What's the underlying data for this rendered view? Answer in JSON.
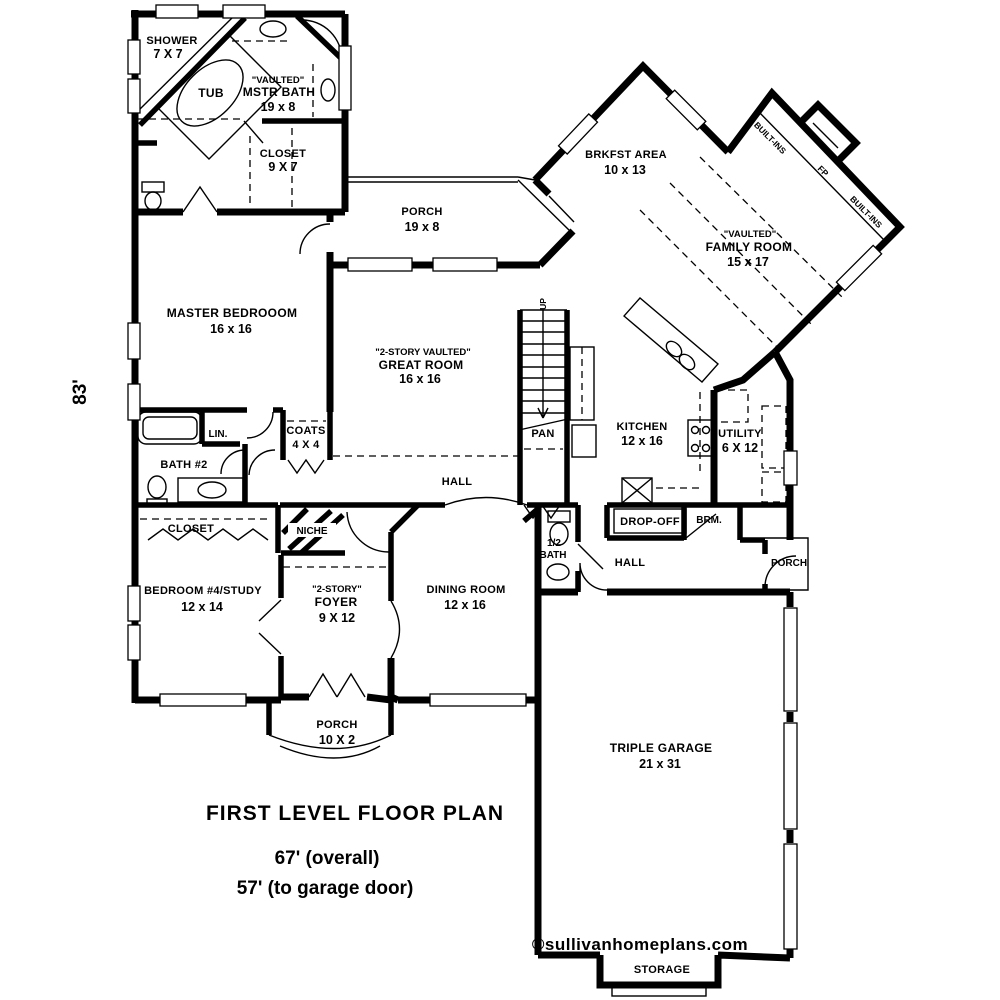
{
  "title_block": {
    "title": "FIRST LEVEL FLOOR PLAN",
    "overall": "67' (overall)",
    "to_garage": "57' (to garage door)"
  },
  "dimensions": {
    "height": "83'"
  },
  "watermark": "©sullivanhomeplans.com",
  "rooms": {
    "shower": {
      "name": "SHOWER",
      "dims": "7 X 7"
    },
    "tub": {
      "name": "TUB"
    },
    "mstr_bath": {
      "tag": "\"VAULTED\"",
      "name": "MSTR BATH",
      "dims": "19 x 8"
    },
    "mstr_closet": {
      "name": "CLOSET",
      "dims": "9 X 7"
    },
    "porch_top": {
      "name": "PORCH",
      "dims": "19 x 8"
    },
    "brkfst": {
      "name": "BRKFST AREA",
      "dims": "10 x 13"
    },
    "family": {
      "tag": "\"VAULTED\"",
      "name": "FAMILY ROOM",
      "dims": "15 x 17"
    },
    "builtins_a": {
      "name": "BUILT-INS"
    },
    "fp": {
      "name": "FP"
    },
    "builtins_b": {
      "name": "BUILT-INS"
    },
    "master": {
      "name": "MASTER BEDROOOM",
      "dims": "16 x 16"
    },
    "great": {
      "tag": "\"2-STORY VAULTED\"",
      "name": "GREAT ROOM",
      "dims": "16 x 16"
    },
    "up": {
      "name": "UP"
    },
    "pan": {
      "name": "PAN"
    },
    "kitchen": {
      "name": "KITCHEN",
      "dims": "12 x 16"
    },
    "utility": {
      "name": "UTILITY",
      "dims": "6 X 12"
    },
    "lin": {
      "name": "LIN."
    },
    "bath2": {
      "name": "BATH #2"
    },
    "coats": {
      "name": "COATS",
      "dims": "4 X 4"
    },
    "hall": {
      "name": "HALL"
    },
    "closet_b4": {
      "name": "CLOSET"
    },
    "niche": {
      "name": "NICHE"
    },
    "dropoff": {
      "name": "DROP-OFF"
    },
    "brm": {
      "name": "BRM."
    },
    "half_bath": {
      "line1": "1/2",
      "line2": "BATH"
    },
    "hall_rear": {
      "name": "HALL"
    },
    "porch_rear": {
      "name": "PORCH"
    },
    "bedroom4": {
      "name": "BEDROOM #4/STUDY",
      "dims": "12 x 14"
    },
    "foyer": {
      "tag": "\"2-STORY\"",
      "name": "FOYER",
      "dims": "9 X 12"
    },
    "dining": {
      "name": "DINING ROOM",
      "dims": "12 x 16"
    },
    "porch_front": {
      "name": "PORCH",
      "dims": "10 X 2"
    },
    "garage": {
      "name": "TRIPLE GARAGE",
      "dims": "21 x 31"
    },
    "storage": {
      "name": "STORAGE"
    }
  },
  "colors": {
    "ink": "#000000",
    "paper": "#ffffff"
  }
}
